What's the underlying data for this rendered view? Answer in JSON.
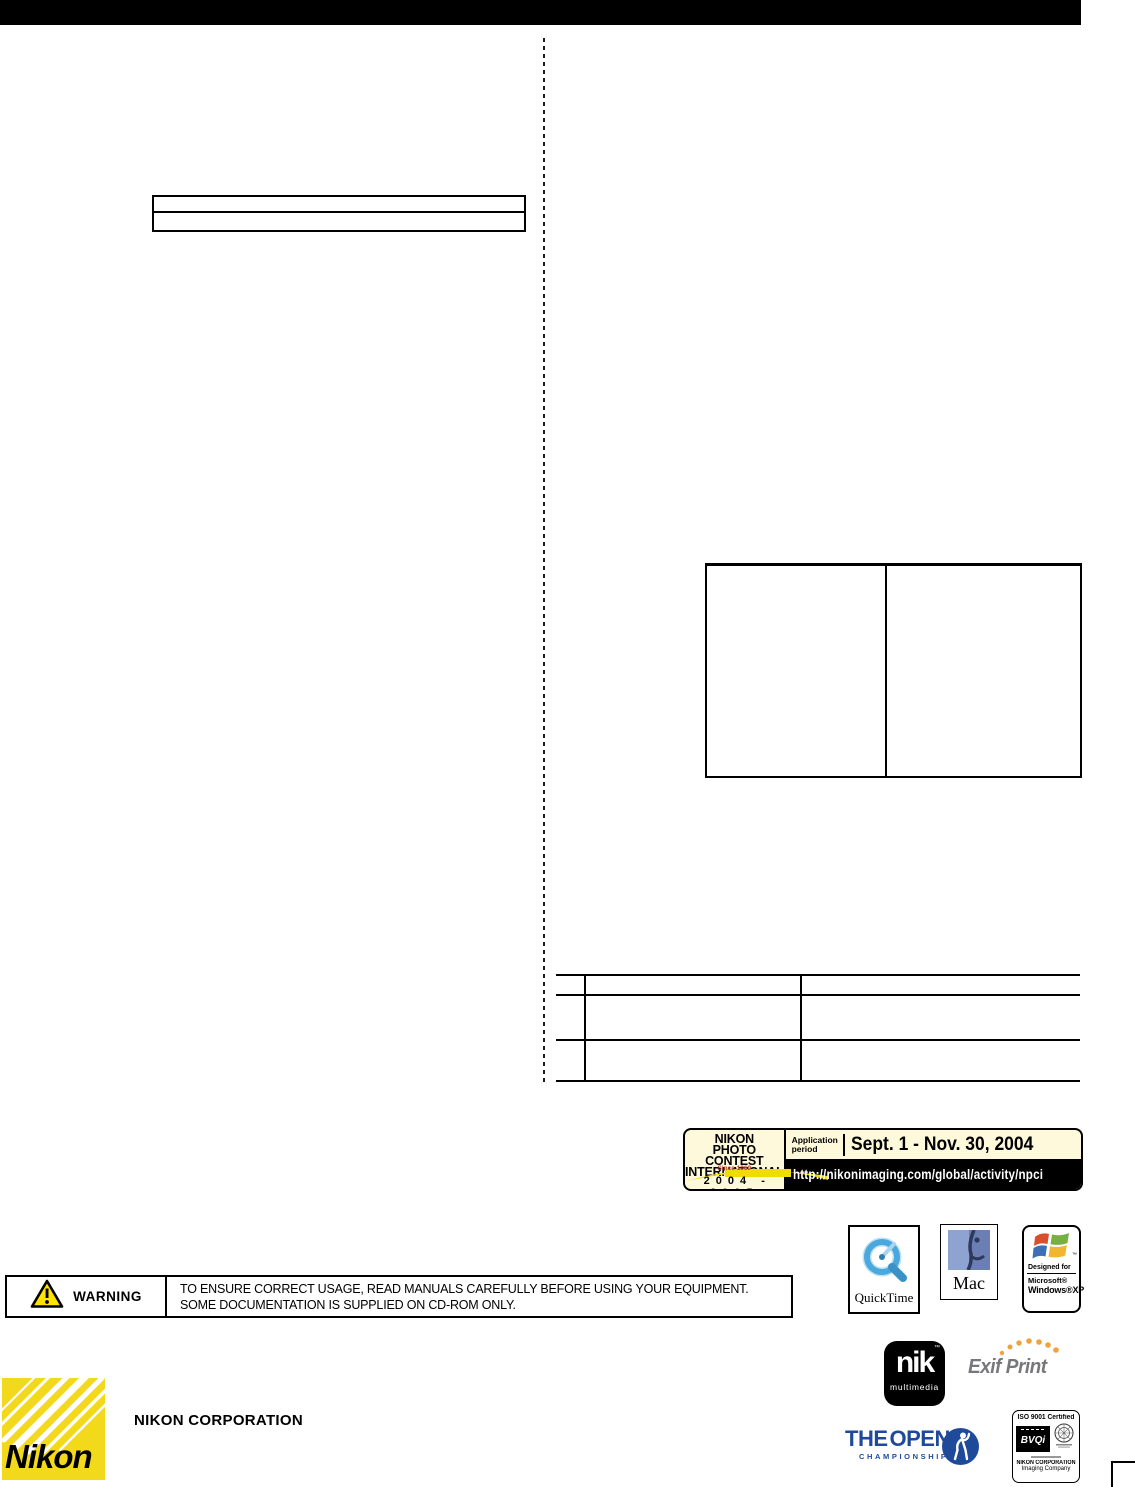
{
  "banner": {
    "title_line1": "NIKON",
    "title_line2": "PHOTO CONTEST",
    "title_line3": "INTERNATIONAL",
    "since": "Since 1969",
    "years": "2004 - 2005",
    "application_line1": "Application",
    "application_line2": "period",
    "dates": "Sept. 1 - Nov. 30, 2004",
    "url": "http://nikonimaging.com/global/activity/npci"
  },
  "warning": {
    "label": "WARNING",
    "line1": "TO ENSURE CORRECT USAGE, READ MANUALS CAREFULLY BEFORE USING YOUR EQUIPMENT.",
    "line2": "SOME DOCUMENTATION IS SUPPLIED ON CD-ROM ONLY."
  },
  "logos": {
    "quicktime": "QuickTime",
    "mac": "Mac",
    "windows_designed_for": "Designed for",
    "windows_microsoft": "Microsoft®",
    "windows_xp": "Windows®XP",
    "windows_tm": "™",
    "nik": "nik",
    "nik_multimedia": "multimedia",
    "nik_tm": "™",
    "exif_print": "Exif Print",
    "open_the": "THE",
    "open_open": "OPEN",
    "open_championship": "CHAMPIONSHIP",
    "iso_title": "ISO 9001 Certified",
    "iso_bvqi": "BVQi",
    "iso_org": "NIKON CORPORATION",
    "iso_division": "Imaging Company"
  },
  "footer": {
    "nikon_wordmark": "Nikon",
    "corporation": "NIKON CORPORATION"
  },
  "icons": {
    "warning_triangle": "yellow triangle with exclamation mark",
    "quicktime_q": "blue Q clock ring",
    "mac_face": "blue Mac face",
    "windows_flag": "four-color waving Windows flag",
    "open_golfer": "navy circle with white golfer",
    "iso_seal": "round certification seal",
    "nikon_rays": "yellow square with white diagonal rays"
  },
  "colors": {
    "nikon_yellow": "#F3D91C",
    "banner_cream": "#FFF9DC",
    "swoosh_yellow": "#EFDC00",
    "since_red": "#B03A2E",
    "open_navy": "#1F4A99",
    "exif_gray": "#77787B",
    "exif_orange": "#F0A23C",
    "warning_yellow": "#FFE200",
    "quicktime_blue": "#4AA8DE"
  }
}
